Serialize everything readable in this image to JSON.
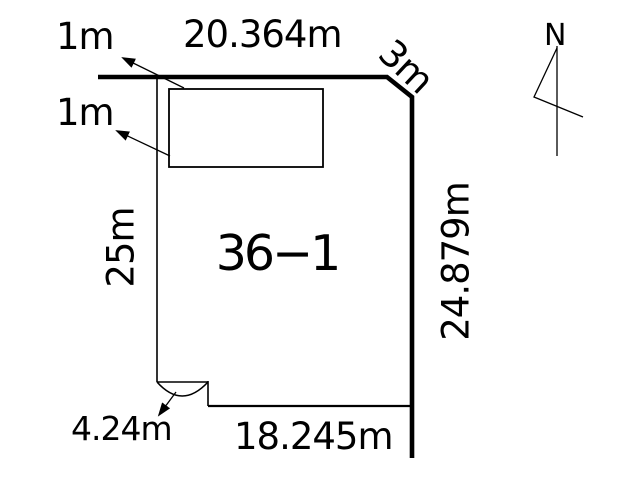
{
  "colors": {
    "line": "#000000",
    "background": "#ffffff",
    "text": "#000000"
  },
  "diagram": {
    "parcel_label": "36−1",
    "dimensions": {
      "top_edge": "20.364m",
      "corner_chamfer": "3m",
      "right_edge": "24.879m",
      "left_edge": "25m",
      "bottom_edge": "18.245m",
      "corner_arc": "4.24m",
      "building_setback_top": "1m",
      "building_setback_left": "1m"
    },
    "compass": {
      "north_label": "N"
    }
  }
}
